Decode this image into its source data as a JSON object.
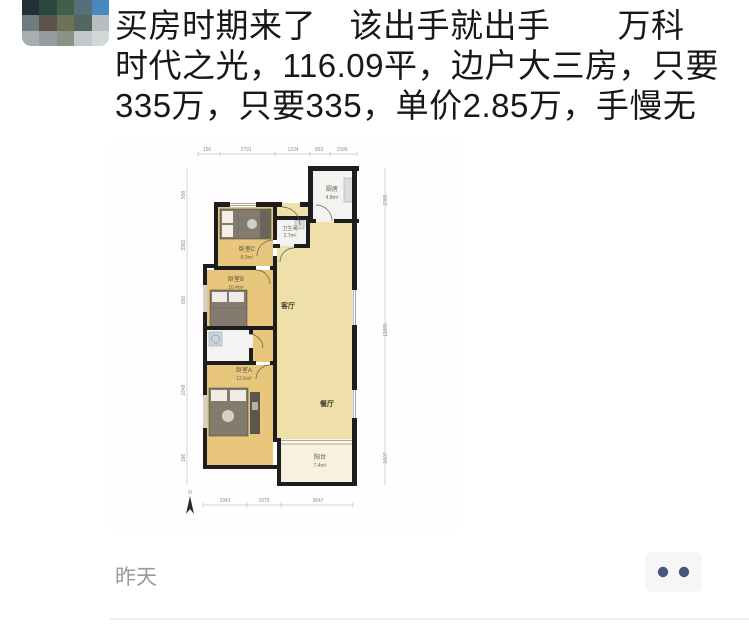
{
  "post": {
    "text_lines": [
      "买房时期来了　该出手就出手　　万科",
      "时代之光，116.09平，边户大三房，只要",
      "335万，只要335，单价2.85万，手慢无"
    ],
    "timestamp": "昨天"
  },
  "avatar": {
    "tiles": [
      "#232f36",
      "#2d473f",
      "#40604d",
      "#56707b",
      "#4a88c0",
      "#6e7c80",
      "#5a544a",
      "#6f7355",
      "#52675e",
      "#b8bdbf",
      "#a8adaf",
      "#969b9d",
      "#8a9187",
      "#c2c7c9",
      "#d3d7d9"
    ]
  },
  "menu": {
    "dots_color": "#47567d"
  },
  "floorplan": {
    "rooms": {
      "kitchen": {
        "name": "厨房",
        "area": "4.8m²"
      },
      "bath": {
        "name": "卫生间",
        "area": "2.7m²"
      },
      "bedroomC": {
        "name": "卧室C",
        "area": "8.0m²"
      },
      "bedroomB": {
        "name": "卧室B",
        "area": "10.4m²"
      },
      "bedroomA": {
        "name": "卧室A",
        "area": "12.6m²"
      },
      "living": {
        "name": "客厅"
      },
      "dining": {
        "name": "餐厅"
      },
      "balcony": {
        "name": "阳台",
        "area": "7.4m²"
      }
    },
    "dims_top": [
      "156",
      "2791",
      "1234",
      "893",
      "1599"
    ],
    "dims_bottom": [
      "1941",
      "1579",
      "3647"
    ],
    "dims_left": [
      "508",
      "2982",
      "650",
      "1848",
      "186"
    ],
    "dims_right": [
      "2385",
      "11885",
      "1607"
    ],
    "north": "N"
  },
  "colors": {
    "wall": "#1d1d1d",
    "bedroom_floor": "#e8c67c",
    "living_floor": "#efe0aa",
    "wet_floor": "#f3f3f1",
    "balcony_floor": "#f7f2df"
  }
}
